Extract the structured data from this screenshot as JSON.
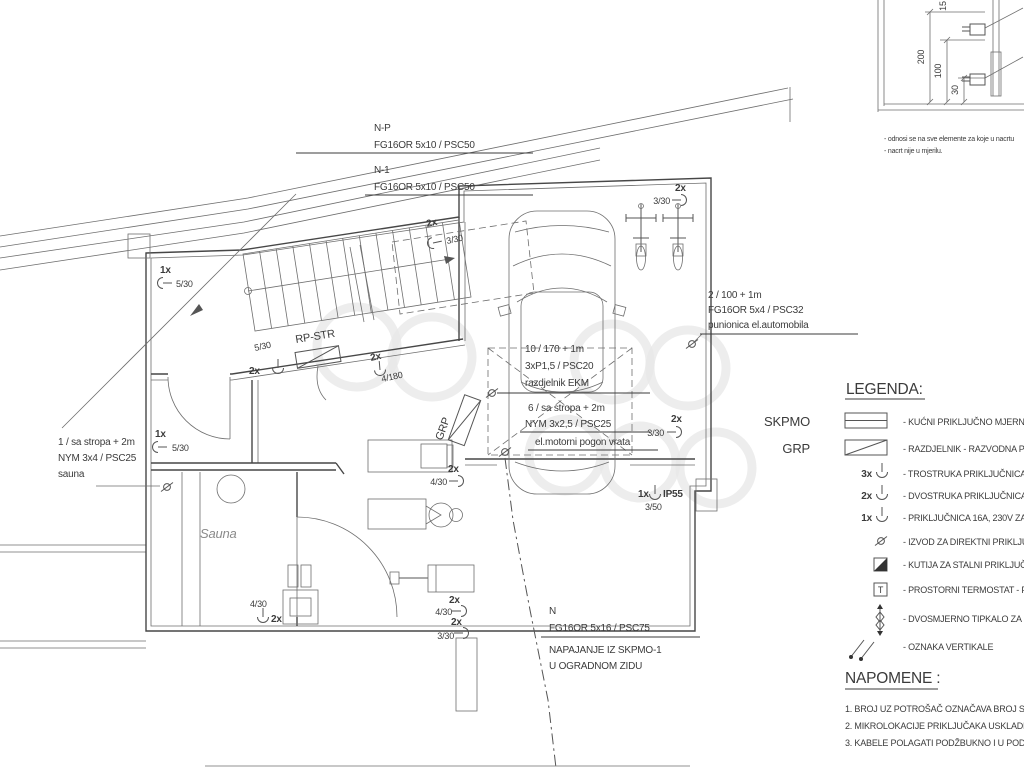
{
  "feeders": {
    "np": {
      "l1": "N-P",
      "l2": "FG16OR 5x10 / PSC50"
    },
    "n1": {
      "l1": "N-1",
      "l2": "FG16OR 5x10 / PSC50"
    },
    "n": {
      "l1": "N",
      "l2": "FG16OR 5x16 / PSC75",
      "l3": "NAPAJANJE IZ SKPMO-1",
      "l4": "U OGRADNOM ZIDU"
    },
    "sauna_feed": {
      "l1": "1 / sa stropa + 2m",
      "l2": "NYM 3x4 / PSC25",
      "l3": "sauna"
    },
    "charger": {
      "l1": "2 / 100 + 1m",
      "l2": "FG16OR 5x4 / PSC32",
      "l3": "punionica el.automobila"
    },
    "ekm": {
      "l1": "10 / 170 + 1m",
      "l2": "3xP1,5 / PSC20",
      "l3": "razdjelnik EKM"
    },
    "door": {
      "l1": "6 / sa stropa + 2m",
      "l2": "NYM 3x2,5 / PSC25",
      "l3": "el.motorni pogon vrata"
    }
  },
  "boards": {
    "rp_str": "RP-STR",
    "grp": "GRP"
  },
  "rooms": {
    "sauna": "Sauna"
  },
  "sockets": [
    {
      "mult": "1x",
      "label": "5/30"
    },
    {
      "mult": "2x",
      "label": "3/30"
    },
    {
      "mult": "2x",
      "label": "3/30"
    },
    {
      "mult": "2x",
      "label": "3/30"
    },
    {
      "mult": "2x",
      "label": "5/30"
    },
    {
      "mult": "2x",
      "label": "4/180"
    },
    {
      "mult": "1x",
      "label": "5/30"
    },
    {
      "mult": "2x",
      "label": "4/30"
    },
    {
      "mult": "1x",
      "label": "3/50",
      "rating": "IP55"
    },
    {
      "mult": "2x",
      "label": "4/30"
    },
    {
      "mult": "2x",
      "label": "4/30"
    },
    {
      "mult": "2x",
      "label": "3/30"
    }
  ],
  "detail": {
    "dims": [
      "200",
      "100",
      "30",
      "15"
    ],
    "notes": [
      "- odnosi se na sve elemente za koje u nacrtu",
      "- nacrt nije u mjerilu."
    ]
  },
  "legend": {
    "title": "LEGENDA:",
    "skpmo_label": "SKPMO",
    "grp_label": "GRP",
    "thermostat_t": "T",
    "items": [
      {
        "desc": "- KUĆNI PRIKLJUČNO MJERNI"
      },
      {
        "desc": "- RAZDJELNIK - RAZVODNA P"
      },
      {
        "desc": "- TROSTRUKA PRIKLJUČNICA"
      },
      {
        "desc": "- DVOSTRUKA PRIKLJUČNICA"
      },
      {
        "desc": "- PRIKLJUČNICA 16A, 230V ZA"
      },
      {
        "desc": "- IZVOD ZA DIREKTNI PRIKLJU"
      },
      {
        "desc": "- KUTIJA ZA STALNI PRIKLJUČ"
      },
      {
        "desc": "- PROSTORNI TERMOSTAT - P"
      },
      {
        "desc": "- DVOSMJERNO TIPKALO ZA"
      },
      {
        "desc": "- OZNAKA VERTIKALE"
      }
    ]
  },
  "napomene": {
    "title": "NAPOMENE :",
    "notes": [
      "1. BROJ UZ POTROŠAČ OZNAČAVA BROJ STR",
      "2. MIKROLOKACIJE PRIKLJUČAKA USKLADITI",
      "3. KABELE POLAGATI PODŽBUKNO I U PODU"
    ]
  }
}
